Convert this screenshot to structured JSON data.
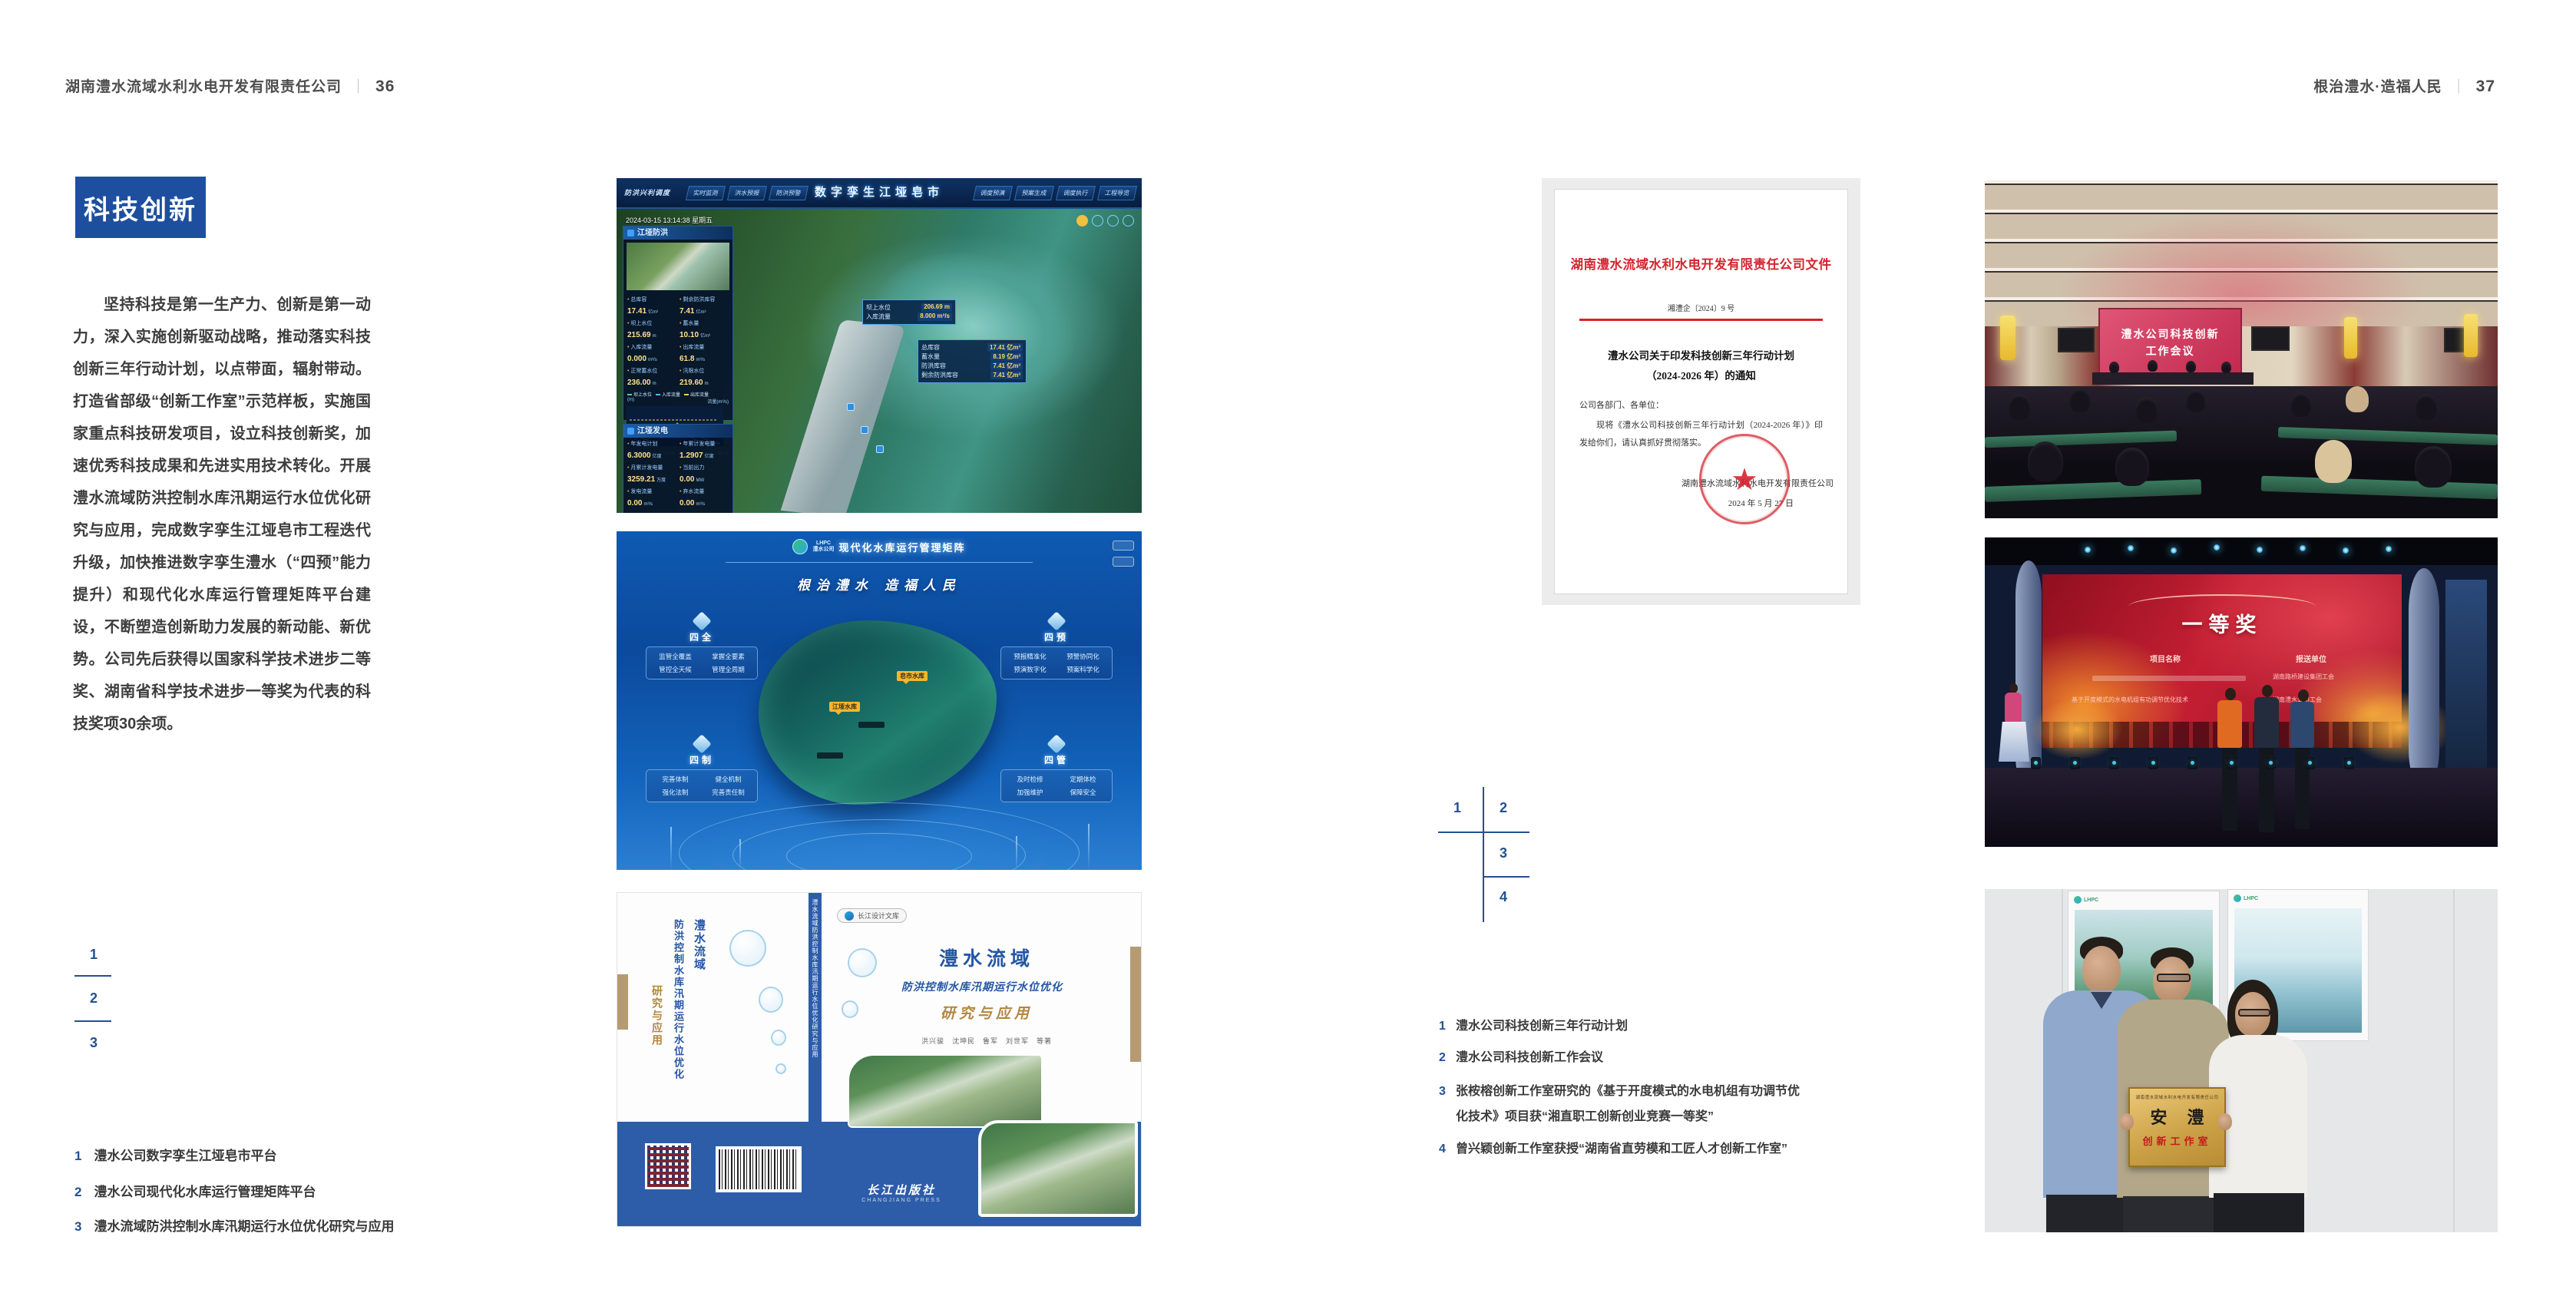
{
  "colors": {
    "brand_blue": "#1d4f9e",
    "index_blue": "#24508f",
    "text_dark": "#3d3d3d",
    "doc_red": "#d5232e",
    "book_blue": "#2d5da9",
    "gold": "#b2863f"
  },
  "left_page": {
    "header": {
      "title": "湖南澧水流域水利水电开发有限责任公司",
      "separator": "｜",
      "page_number": "36"
    },
    "badge": "科技创新",
    "paragraph": "坚持科技是第一生产力、创新是第一动力，深入实施创新驱动战略，推动落实科技创新三年行动计划，以点带面，辐射带动。打造省部级“创新工作室”示范样板，实施国家重点科技研发项目，设立科技创新奖，加速优秀科技成果和先进实用技术转化。开展澧水流域防洪控制水库汛期运行水位优化研究与应用，完成数字孪生江垭皂市工程迭代升级，加快推进数字孪生澧水（“四预”能力提升）和现代化水库运行管理矩阵平台建设，不断塑造创新助力发展的新动能、新优势。公司先后获得以国家科学技术进步二等奖、湖南省科学技术进步一等奖为代表的科技奖项30余项。",
    "index": {
      "n1": "1",
      "n2": "2",
      "n3": "3"
    },
    "captions": [
      {
        "num": "1",
        "text": "澧水公司数字孪生江垭皂市平台"
      },
      {
        "num": "2",
        "text": "澧水公司现代化水库运行管理矩阵平台"
      },
      {
        "num": "3",
        "text": "澧水流域防洪控制水库汛期运行水位优化研究与应用"
      }
    ]
  },
  "right_page": {
    "header": {
      "title": "根治澧水·造福人民",
      "separator": "｜",
      "page_number": "37"
    },
    "index": {
      "n1": "1",
      "n2": "2",
      "n3": "3",
      "n4": "4"
    },
    "captions": [
      {
        "num": "1",
        "text": "澧水公司科技创新三年行动计划"
      },
      {
        "num": "2",
        "text": "澧水公司科技创新工作会议"
      },
      {
        "num": "3",
        "text": "张桉榕创新工作室研究的《基于开度模式的水电机组有功调节优化技术》项目获“湘直职工创新创业竞赛一等奖”"
      },
      {
        "num": "4",
        "text": "曾兴颖创新工作室获授“湖南省直劳模和工匠人才创新工作室”"
      }
    ]
  },
  "figures": {
    "dashboard": {
      "title": "数字孪生江垭皂市",
      "menu_label": "防洪兴利调度",
      "tabs_left": [
        "实时监测",
        "洪水预报",
        "防洪预警"
      ],
      "tabs_right": [
        "调度预演",
        "预案生成",
        "调度执行",
        "工程导览"
      ],
      "timestamp": "2024-03-15 13:14:38 星期五",
      "panel1_title": "江垭防洪",
      "stats1": [
        {
          "label": "总库容",
          "value": "17.41",
          "unit": "亿m³"
        },
        {
          "label": "剩余防洪库容",
          "value": "7.41",
          "unit": "亿m³"
        },
        {
          "label": "坝上水位",
          "value": "215.69",
          "unit": "m"
        },
        {
          "label": "蓄水量",
          "value": "10.10",
          "unit": "亿m³"
        },
        {
          "label": "入库流量",
          "value": "0.000",
          "unit": "m³/s"
        },
        {
          "label": "出库流量",
          "value": "61.8",
          "unit": "m³/s"
        },
        {
          "label": "正常蓄水位",
          "value": "236.00",
          "unit": "m"
        },
        {
          "label": "汛限水位",
          "value": "219.60",
          "unit": "m"
        }
      ],
      "chart": {
        "legend": [
          "坝上水位",
          "入库流量",
          "出库流量"
        ],
        "axis_left": "(m)",
        "axis_right": "流量(m³/s)",
        "x": [
          "03-12",
          "03-13",
          "03-13",
          "03-13",
          "03-14",
          "03-14"
        ]
      },
      "panel2_title": "江垭发电",
      "stats2": [
        {
          "label": "年发电计划",
          "value": "6.3000",
          "unit": "亿度"
        },
        {
          "label": "年累计发电量",
          "value": "1.2907",
          "unit": "亿度"
        },
        {
          "label": "月累计发电量",
          "value": "3259.21",
          "unit": "万度"
        },
        {
          "label": "当前出力",
          "value": "0.00",
          "unit": "MW"
        },
        {
          "label": "发电流量",
          "value": "0.00",
          "unit": "m³/s"
        },
        {
          "label": "弃水流量",
          "value": "0.00",
          "unit": "m³/s"
        }
      ],
      "gauges": [
        "0.00",
        "700.98",
        "0.00"
      ],
      "tooltip1": [
        {
          "label": "坝上水位",
          "value": "206.69 m"
        },
        {
          "label": "入库流量",
          "value": "8.000 m³/s"
        }
      ],
      "tooltip2": [
        {
          "label": "总库容",
          "value": "17.41 亿m³"
        },
        {
          "label": "蓄水量",
          "value": "8.19 亿m³"
        },
        {
          "label": "防洪库容",
          "value": "7.41 亿m³"
        },
        {
          "label": "剩余防洪库容",
          "value": "7.41 亿m³"
        }
      ]
    },
    "matrix": {
      "brand_abbr": "LHPC",
      "brand": "澧水公司",
      "title": "现代化水库运行管理矩阵",
      "slogan": "根治澧水 造福人民",
      "panels": [
        {
          "name": "四全",
          "items": [
            "监管全覆盖",
            "掌握全要素",
            "管控全天候",
            "管理全周期"
          ]
        },
        {
          "name": "四预",
          "items": [
            "预报精准化",
            "预警协同化",
            "预演数字化",
            "预案科学化"
          ]
        },
        {
          "name": "四制",
          "items": [
            "完善体制",
            "健全机制",
            "强化法制",
            "完善责任制"
          ]
        },
        {
          "name": "四管",
          "items": [
            "及时检修",
            "定期体检",
            "加强维护",
            "保障安全"
          ]
        }
      ],
      "marker1": "皂市水库",
      "marker2": "江垭水库"
    },
    "book": {
      "series": "长江设计文库",
      "title_main": "澧水流域",
      "title_sub": "防洪控制水库汛期运行水位优化",
      "title_tail": "研究与应用",
      "authors": "洪兴骏　沈坤民　鲁军　刘世军　等著",
      "publisher": "长江出版社",
      "publisher_en": "CHANGJIANG PRESS",
      "spine": "澧水流域防洪控制水库汛期运行水位优化研究与应用"
    },
    "document": {
      "letterhead": "湖南澧水流域水利水电开发有限责任公司文件",
      "doc_no": "湘澧企〔2024〕9 号",
      "title_line1": "澧水公司关于印发科技创新三年行动计划",
      "title_line2": "（2024-2026 年）的通知",
      "salutation": "公司各部门、各单位：",
      "body": "现将《澧水公司科技创新三年行动计划（2024-2026 年）》印发给你们，请认真抓好贯彻落实。",
      "signer": "湖南澧水流域水利水电开发有限责任公司",
      "date": "2024 年 5 月 27 日",
      "seal_star": "★"
    },
    "meeting": {
      "screen_line1": "澧水公司科技创新",
      "screen_line2": "工作会议"
    },
    "stage": {
      "award": "一等奖",
      "col_project": "项目名称",
      "col_unit": "报送单位",
      "row1_unit": "湖南路桥建设集团工会",
      "row2_project": "基于开度模式的水电机组有功调节优化技术",
      "row2_unit": "湖南澧水公司工会"
    },
    "group": {
      "poster_abbr": "LHPC",
      "plaque_header": "湖南澧水流域水利水电开发有限责任公司",
      "plaque_title": "安澧",
      "plaque_sub": "创新工作室"
    }
  }
}
